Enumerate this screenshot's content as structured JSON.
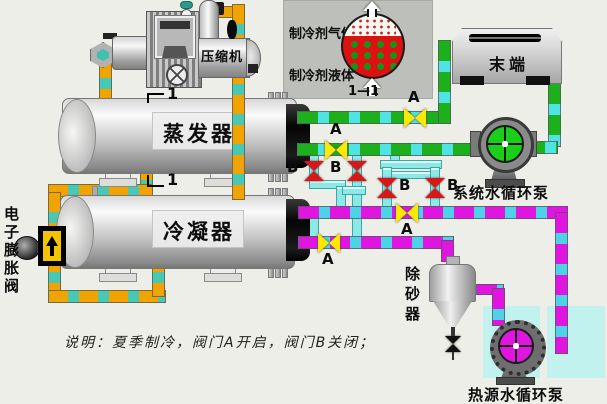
{
  "diagram": {
    "note": "说明：夏季制冷，阀门A开启，阀门B关闭；",
    "section_mark": "1"
  },
  "equipment": {
    "compressor": "压缩机",
    "evaporator": "蒸发器",
    "condenser": "冷凝器",
    "expansion_valve": "电子膨胀阀",
    "terminal": "末端",
    "system_pump": "系统水循环泵",
    "heat_source_pump": "热源水循环泵",
    "sand_remover": "除砂器"
  },
  "inset": {
    "gas_label": "制冷剂气体",
    "liquid_label": "制冷剂液体",
    "section_caption": "1—1"
  },
  "valve_labels": {
    "open": "A",
    "closed": "B"
  },
  "colors": {
    "background": "#EDEEE8",
    "refrigerant_pipe": "#F1A300",
    "refrigerant_dash": "#49C8B4",
    "chilled_water_pipe": "#1CB01C",
    "heat_source_pipe": "#E016E0",
    "water_dash": "#4FE3E3",
    "crossover_pipe": "#8EE8E8",
    "valve_open_color": "#FFE800",
    "valve_closed_color": "#D81818",
    "inset_panel": "#BDC0BA",
    "tank": "#C2F2EE"
  }
}
